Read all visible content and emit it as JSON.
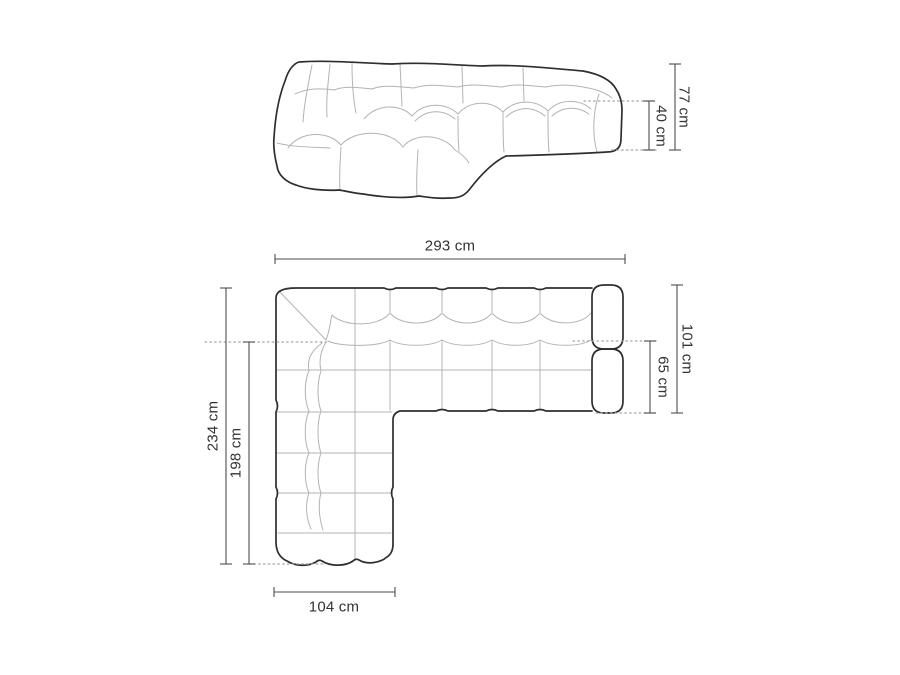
{
  "diagram": {
    "type": "sofa-dimension-technical-drawing",
    "unit": "cm",
    "front_view": {
      "name": "front perspective view",
      "total_height": "77 cm",
      "seat_height": "40 cm"
    },
    "top_view": {
      "name": "top plan view",
      "total_width": "293 cm",
      "right_depth": "101 cm",
      "right_seat_depth": "65 cm",
      "left_depth": "234 cm",
      "left_inner_depth": "198 cm",
      "chaise_width": "104 cm"
    }
  },
  "colors": {
    "background": "#ffffff",
    "sofa_outline": "#2e2e2e",
    "cushion_seam": "#b3b3b3",
    "dimension_line": "#4d4d4d",
    "dotted_reference_line": "#a6a6a6",
    "label_text": "#333333"
  }
}
